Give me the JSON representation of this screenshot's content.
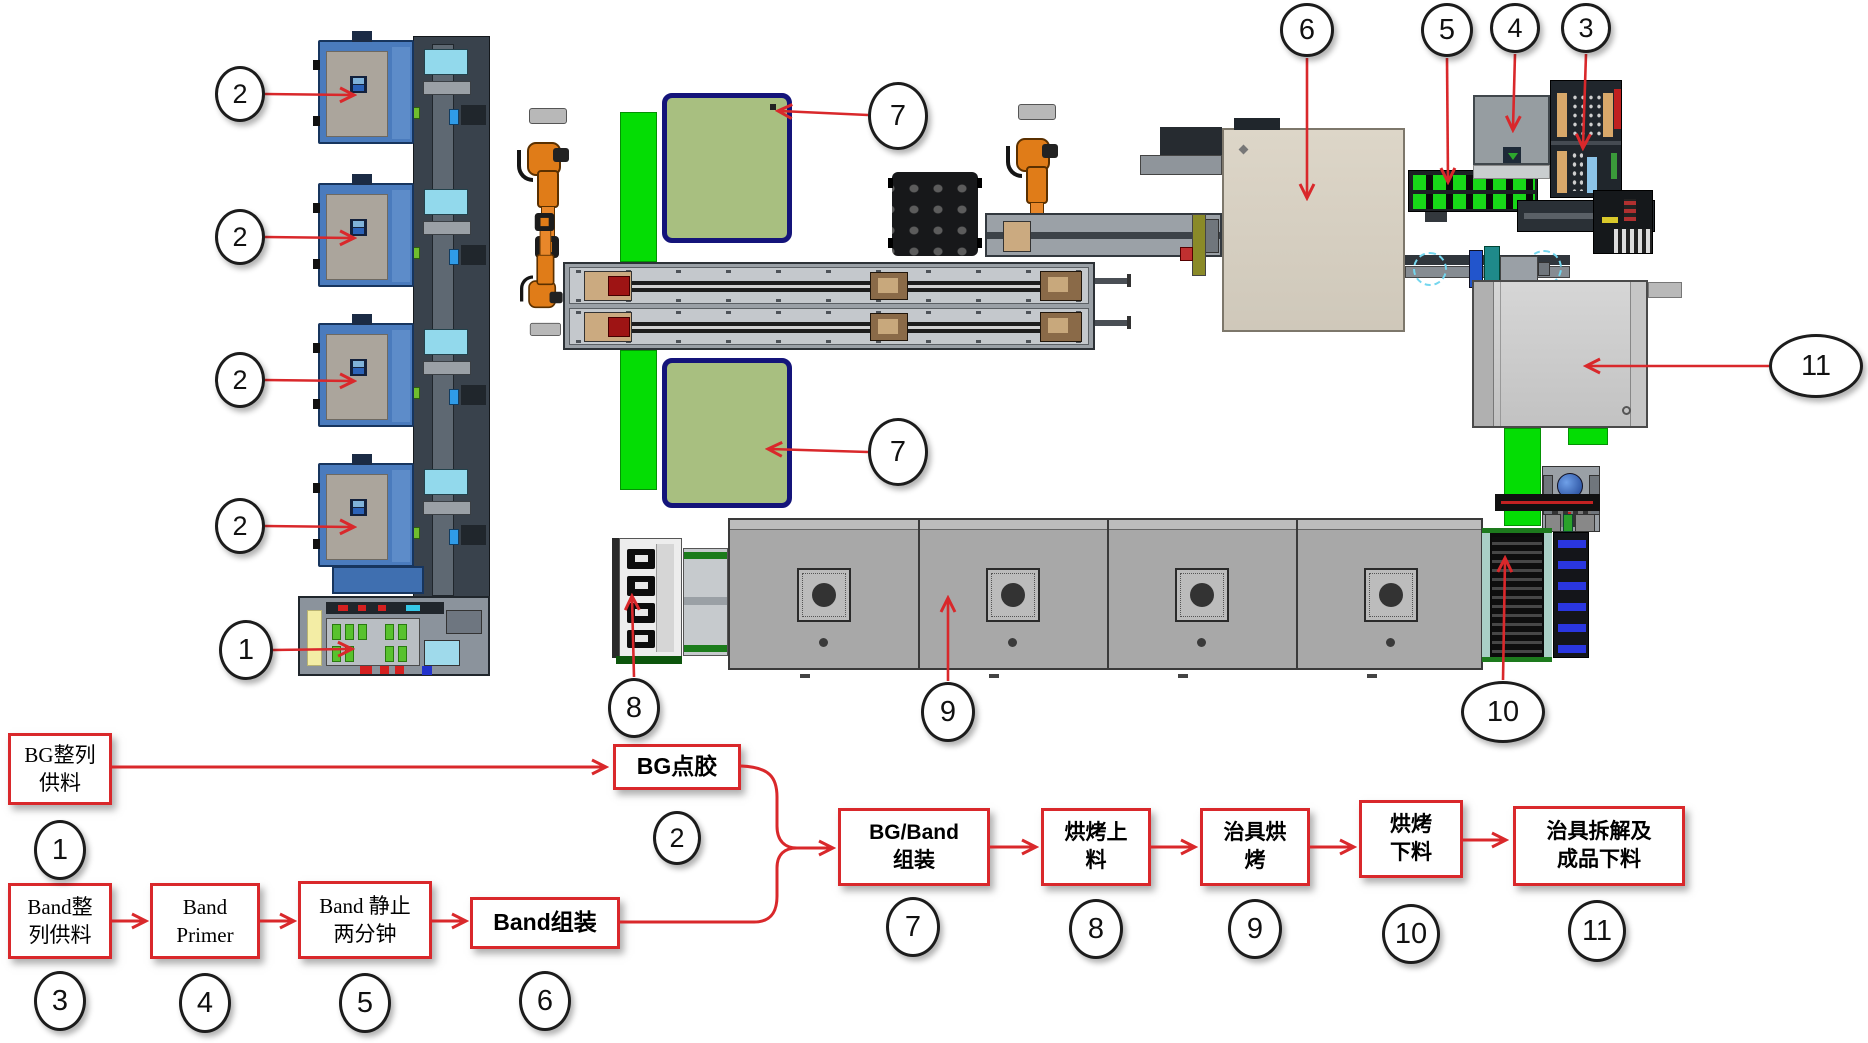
{
  "colors": {
    "arrow_red": "#d9282b",
    "flow_box_border": "#d9282b",
    "bright_green": "#04dd04",
    "pallet_green_fill": "#a8bf80",
    "pallet_navy_border": "#14147a",
    "machine_blue": "#4a7bbd",
    "robot_orange": "#e07c18",
    "oven_gray": "#a8a8a8",
    "assembly_beige": "#d8d1c3",
    "callout_border": "#1c1c1c"
  },
  "callouts": {
    "tray1": "2",
    "tray2": "2",
    "tray3": "2",
    "tray4": "2",
    "base": "1",
    "pallet_top": "7",
    "pallet_bottom": "7",
    "assembly": "6",
    "conveyor": "5",
    "primer": "4",
    "feeder": "3",
    "unload": "11",
    "bake_unload": "10",
    "oven": "9",
    "bake_load": "8"
  },
  "flow": {
    "bg_feed": {
      "label": "BG整列\n供料",
      "num": "1"
    },
    "bg_glue": {
      "label": "BG点胶",
      "num": "2"
    },
    "band_feed": {
      "label": "Band整\n列供料",
      "num": "3"
    },
    "band_primer": {
      "label": "Band\nPrimer",
      "num": "4"
    },
    "band_rest": {
      "label": "Band 静止\n两分钟",
      "num": "5"
    },
    "band_asm": {
      "label": "Band组装",
      "num": "6"
    },
    "bg_band_asm": {
      "label": "BG/Band\n组装",
      "num": "7"
    },
    "bake_load": {
      "label": "烘烤上\n料",
      "num": "8"
    },
    "jig_bake": {
      "label": "治具烘\n烤",
      "num": "9"
    },
    "bake_unload": {
      "label": "烘烤\n下料",
      "num": "10"
    },
    "jig_dismantle": {
      "label": "治具拆解及\n成品下料",
      "num": "11"
    }
  }
}
